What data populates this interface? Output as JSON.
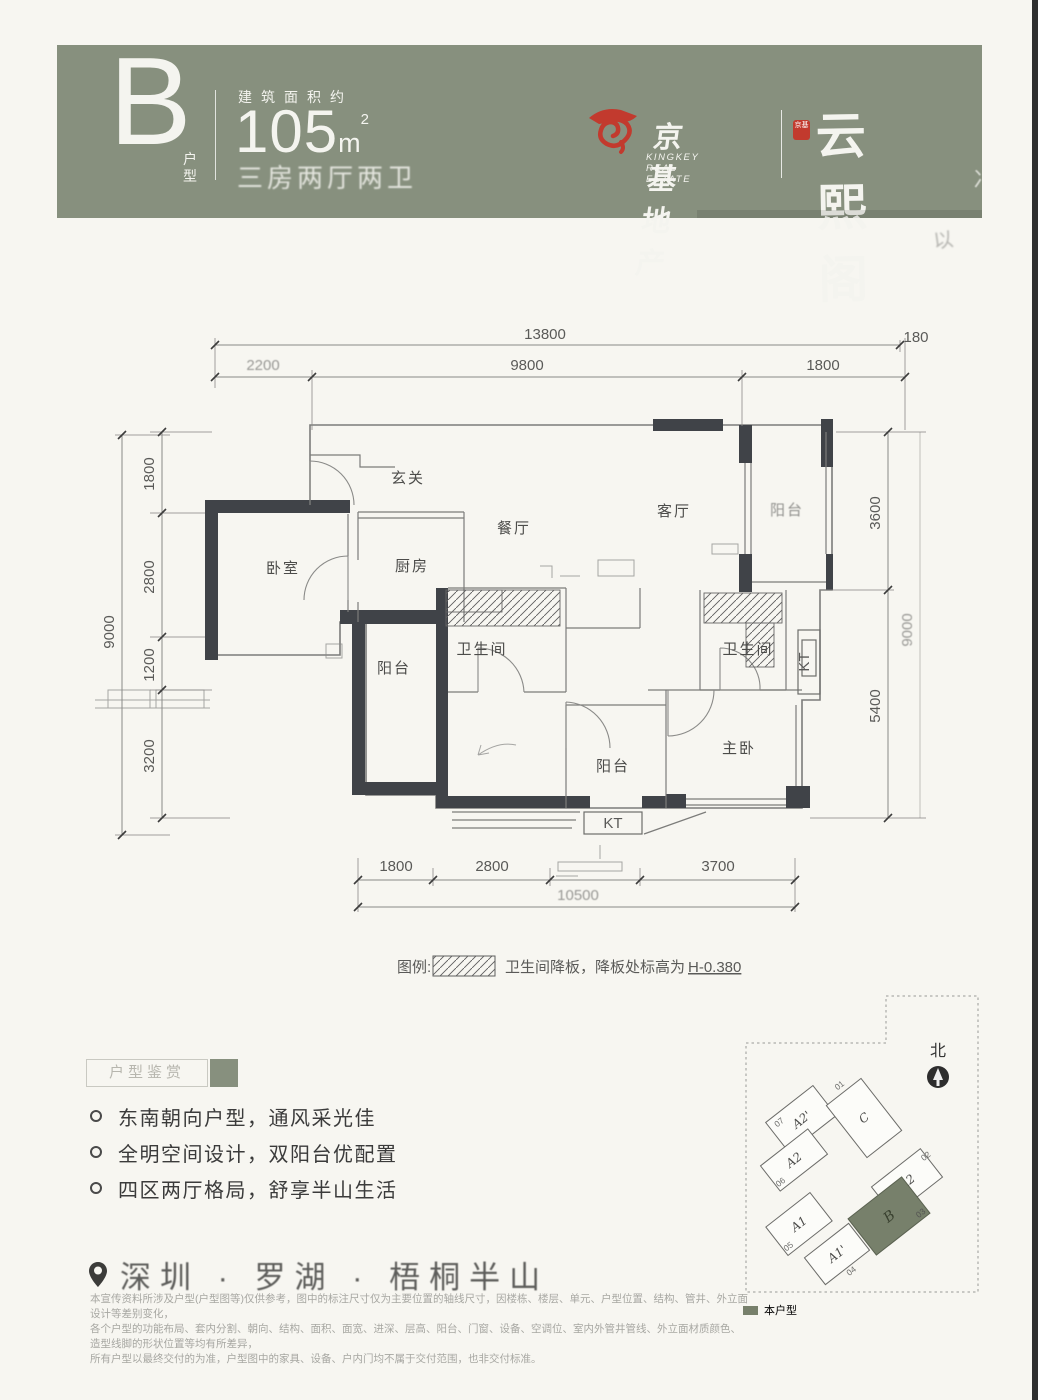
{
  "header": {
    "type_letter": "B",
    "type_suffix": "户型",
    "area_label": "建筑面积约",
    "area_value": "105",
    "area_unit": "m",
    "area_sup": "2",
    "layout_desc": "三房两厅两卫",
    "brand": {
      "cn": "京基地产",
      "en": "KINGKEY REAL ESTATE",
      "seal": "京基",
      "project": "云熙阁"
    }
  },
  "colors": {
    "band_green": "#87907E",
    "accent_green": "#77806B",
    "logo_red": "#C23A2E",
    "wall_dark": "#404348"
  },
  "floor_plan": {
    "rooms": {
      "entry": "玄关",
      "dining": "餐厅",
      "living": "客厅",
      "balcony_right": "阳台",
      "bedroom": "卧室",
      "kitchen": "厨房",
      "bath1": "卫生间",
      "balcony1": "阳台",
      "bath2": "卫生间",
      "master": "主卧",
      "balcony2": "阳台",
      "kt": "KT"
    },
    "dims_top": {
      "overall": "13800",
      "edge": "180",
      "segments": [
        "2200",
        "9800",
        "1800"
      ]
    },
    "dims_left": {
      "overall": "9000",
      "segments": [
        "1800",
        "2800",
        "1200",
        "3200"
      ]
    },
    "dims_right": {
      "overall": "9000",
      "segments": [
        "3600",
        "5400"
      ]
    },
    "dims_bottom": {
      "overall": "10500",
      "segments": [
        "1800",
        "2800",
        "3700"
      ]
    },
    "legend": {
      "prefix": "图例:",
      "text": "卫生间降板，降板处标高为",
      "value": "H-0.380"
    }
  },
  "appreciation": {
    "title": "户型鉴赏",
    "bullets": [
      "东南朝向户型，通风采光佳",
      "全明空间设计，双阳台优配置",
      "四区两厅格局，舒享半山生活"
    ]
  },
  "location": {
    "text": "深圳 · 罗湖 · 梧桐半山"
  },
  "disclaimer": {
    "lines": [
      "本宣传资料所涉及户型(户型图等)仅供参考，图中的标注尺寸仅为主要位置的轴线尺寸，因楼栋、楼层、单元、户型位置、结构、管井、外立面设计等差别变化，",
      "各个户型的功能布局、套内分割、朝向、结构、面积、面宽、进深、层高、阳台、门窗、设备、空调位、室内外管井管线、外立面材质颜色、造型线脚的形状位置等均有所差异，",
      "所有户型以最终交付的为准，户型图中的家具、设备、户内门均不属于交付范围，也非交付标准。"
    ]
  },
  "site_plan": {
    "north_label": "北",
    "legend_label": "本户型",
    "buildings": [
      {
        "unit": "A2'",
        "no": "07"
      },
      {
        "unit": "A2",
        "no": "06"
      },
      {
        "unit": "C",
        "no": "01"
      },
      {
        "unit": "A2",
        "no": "02"
      },
      {
        "unit": "B",
        "no": "03",
        "highlight": true
      },
      {
        "unit": "A1",
        "no": "05"
      },
      {
        "unit": "A1'",
        "no": "04"
      }
    ]
  }
}
